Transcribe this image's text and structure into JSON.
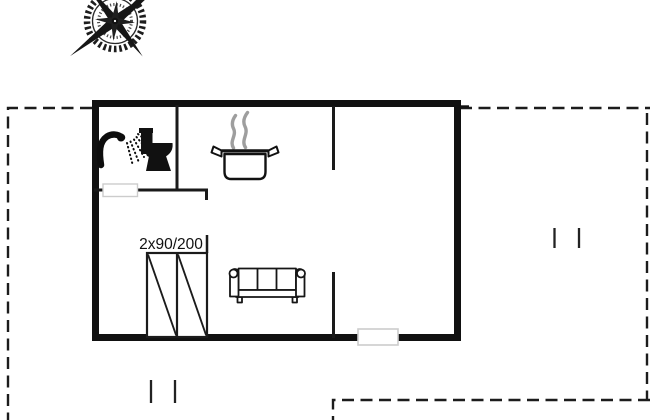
{
  "page": {
    "type": "holiday-home floor plan drawing",
    "background": "#ffffff"
  },
  "floorplan": {
    "bed_label": "2x90/200",
    "icons": {
      "compass": "compass-rose-icon",
      "bathroom": [
        "shower-icon",
        "toilet-icon"
      ],
      "kitchen": [
        "cooking-pot-icon",
        "steam-icon"
      ],
      "living_room": [
        "sofa-icon"
      ],
      "bedroom": [
        "twin-bed-icon"
      ]
    },
    "colors": {
      "wall": "#111111",
      "interior_wall": "#1a1a1a",
      "boundary": "#1c1c1c",
      "steam": "#9e9e9e",
      "door_outline": "#cccccc",
      "background": "#ffffff"
    }
  }
}
